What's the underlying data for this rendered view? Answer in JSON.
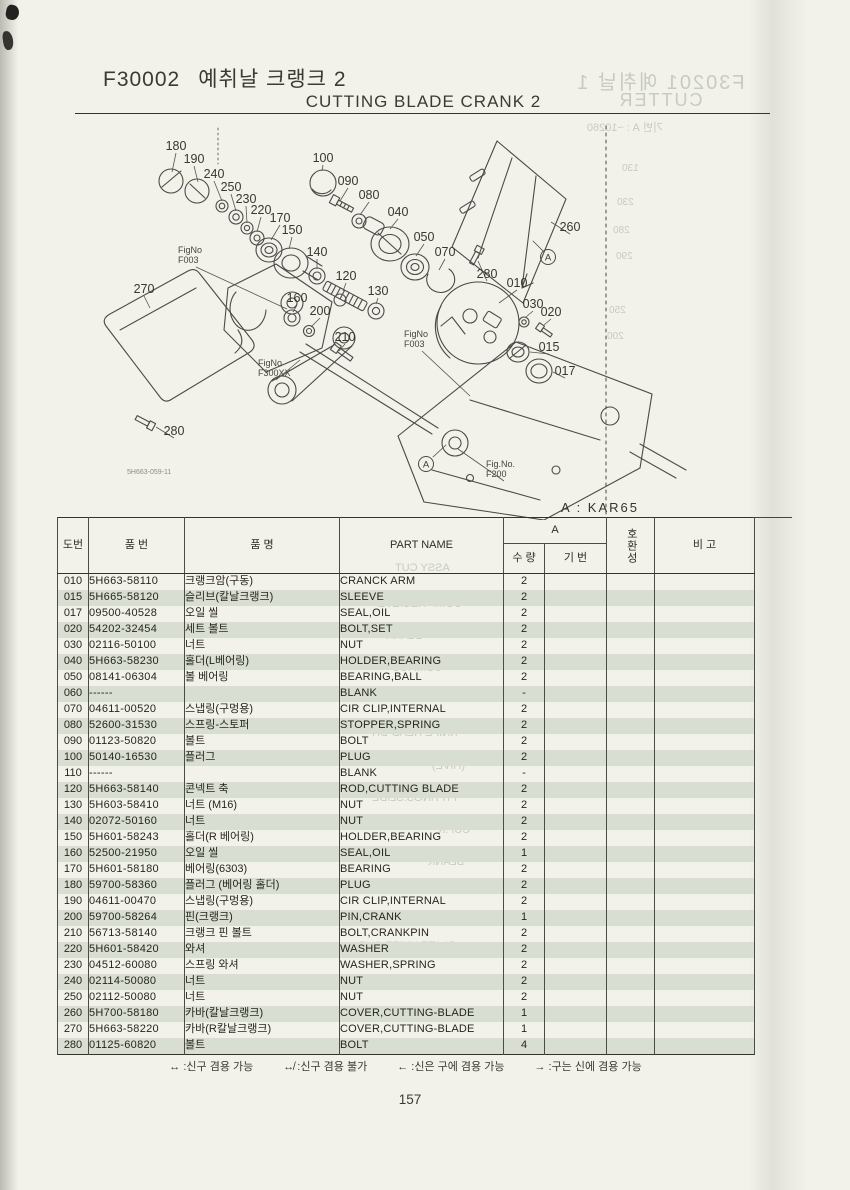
{
  "title": {
    "code": "F30002",
    "kr": "예취날 크랭크 2",
    "en": "CUTTING BLADE CRANK 2"
  },
  "applicability": {
    "label": "A : KAR65"
  },
  "page": {
    "number": "157"
  },
  "diagram": {
    "drawing_no": "5H663-059-11",
    "a_marker_label": "A",
    "a_markers": [
      {
        "x": 548,
        "y": 257
      },
      {
        "x": 426,
        "y": 464
      }
    ],
    "callouts": [
      {
        "label": "180",
        "x": 176,
        "y": 150,
        "lx": 172,
        "ly": 172
      },
      {
        "label": "190",
        "x": 194,
        "y": 163,
        "lx": 198,
        "ly": 182
      },
      {
        "label": "240",
        "x": 214,
        "y": 178,
        "lx": 222,
        "ly": 201
      },
      {
        "label": "250",
        "x": 231,
        "y": 191,
        "lx": 236,
        "ly": 211
      },
      {
        "label": "230",
        "x": 246,
        "y": 203,
        "lx": 247,
        "ly": 223
      },
      {
        "label": "220",
        "x": 261,
        "y": 214,
        "lx": 257,
        "ly": 232
      },
      {
        "label": "170",
        "x": 280,
        "y": 222,
        "lx": 271,
        "ly": 240
      },
      {
        "label": "150",
        "x": 292,
        "y": 234,
        "lx": 289,
        "ly": 249
      },
      {
        "label": "140",
        "x": 317,
        "y": 256,
        "lx": 317,
        "ly": 269
      },
      {
        "label": "100",
        "x": 323,
        "y": 162,
        "lx": 322,
        "ly": 171
      },
      {
        "label": "090",
        "x": 348,
        "y": 185,
        "lx": 340,
        "ly": 201
      },
      {
        "label": "080",
        "x": 369,
        "y": 199,
        "lx": 360,
        "ly": 215
      },
      {
        "label": "040",
        "x": 398,
        "y": 216,
        "lx": 390,
        "ly": 229
      },
      {
        "label": "050",
        "x": 424,
        "y": 241,
        "lx": 416,
        "ly": 256
      },
      {
        "label": "070",
        "x": 445,
        "y": 256,
        "lx": 439,
        "ly": 270
      },
      {
        "label": "120",
        "x": 346,
        "y": 280,
        "lx": 343,
        "ly": 291
      },
      {
        "label": "130",
        "x": 378,
        "y": 295,
        "lx": 376,
        "ly": 304
      },
      {
        "label": "260",
        "x": 570,
        "y": 231,
        "lx": 551,
        "ly": 222
      },
      {
        "label": "280",
        "x": 487,
        "y": 278,
        "lx": 478,
        "ly": 261
      },
      {
        "label": "010",
        "x": 517,
        "y": 287,
        "lx": 499,
        "ly": 303
      },
      {
        "label": "030",
        "x": 533,
        "y": 308,
        "lx": 526,
        "ly": 317
      },
      {
        "label": "020",
        "x": 551,
        "y": 316,
        "lx": 544,
        "ly": 325
      },
      {
        "label": "015",
        "x": 549,
        "y": 351,
        "lx": 530,
        "ly": 352
      },
      {
        "label": "017",
        "x": 565,
        "y": 375,
        "lx": 553,
        "ly": 372
      },
      {
        "label": "270",
        "x": 144,
        "y": 293,
        "lx": 150,
        "ly": 308
      },
      {
        "label": "280",
        "x": 174,
        "y": 435,
        "lx": 156,
        "ly": 427
      },
      {
        "label": "160",
        "x": 297,
        "y": 302,
        "lx": 293,
        "ly": 312
      },
      {
        "label": "200",
        "x": 320,
        "y": 315,
        "lx": 311,
        "ly": 327
      },
      {
        "label": "210",
        "x": 345,
        "y": 341,
        "lx": 339,
        "ly": 351
      }
    ],
    "fig_labels": [
      {
        "lines": [
          "FigNo",
          "F003"
        ],
        "x": 178,
        "y": 253,
        "lx": 287,
        "ly": 309
      },
      {
        "lines": [
          "FigNo",
          "F300XX"
        ],
        "x": 258,
        "y": 366,
        "lx": 300,
        "ly": 360
      },
      {
        "lines": [
          "FigNo",
          "F003"
        ],
        "x": 404,
        "y": 337,
        "lx": 470,
        "ly": 396
      },
      {
        "lines": [
          "Fig.No.",
          "F200"
        ],
        "x": 486,
        "y": 467,
        "lx": 458,
        "ly": 449
      }
    ]
  },
  "table": {
    "headers": {
      "no": "도번",
      "part_no": "품   번",
      "name_kr": "품      명",
      "part_name": "PART NAME",
      "group": "A",
      "qty": "수 량",
      "serial": "기 번",
      "interchange": "호환성",
      "remarks": "비   고"
    },
    "rows": [
      {
        "no": "010",
        "part_no": "5H663-58110",
        "name_kr": "크랭크암(구동)",
        "part_name": "CRANCK ARM",
        "qty": "2"
      },
      {
        "no": "015",
        "part_no": "5H665-58120",
        "name_kr": "슬리브(칼날크랭크)",
        "part_name": "SLEEVE",
        "qty": "2"
      },
      {
        "no": "017",
        "part_no": "09500-40528",
        "name_kr": "오일 씰",
        "part_name": "SEAL,OIL",
        "qty": "2"
      },
      {
        "no": "020",
        "part_no": "54202-32454",
        "name_kr": "세트 볼트",
        "part_name": "BOLT,SET",
        "qty": "2"
      },
      {
        "no": "030",
        "part_no": "02116-50100",
        "name_kr": "너트",
        "part_name": "NUT",
        "qty": "2"
      },
      {
        "no": "040",
        "part_no": "5H663-58230",
        "name_kr": "홀더(L베어링)",
        "part_name": "HOLDER,BEARING",
        "qty": "2"
      },
      {
        "no": "050",
        "part_no": "08141-06304",
        "name_kr": "볼 베어링",
        "part_name": "BEARING,BALL",
        "qty": "2"
      },
      {
        "no": "060",
        "part_no": "------",
        "name_kr": "",
        "part_name": "BLANK",
        "qty": "-"
      },
      {
        "no": "070",
        "part_no": "04611-00520",
        "name_kr": "스냅링(구멍용)",
        "part_name": "CIR CLIP,INTERNAL",
        "qty": "2"
      },
      {
        "no": "080",
        "part_no": "52600-31530",
        "name_kr": "스프링-스토퍼",
        "part_name": "STOPPER,SPRING",
        "qty": "2"
      },
      {
        "no": "090",
        "part_no": "01123-50820",
        "name_kr": "볼트",
        "part_name": "BOLT",
        "qty": "2"
      },
      {
        "no": "100",
        "part_no": "50140-16530",
        "name_kr": "플러그",
        "part_name": "PLUG",
        "qty": "2"
      },
      {
        "no": "110",
        "part_no": "------",
        "name_kr": "",
        "part_name": "BLANK",
        "qty": "-"
      },
      {
        "no": "120",
        "part_no": "5H663-58140",
        "name_kr": "콘넥트 축",
        "part_name": "ROD,CUTTING BLADE",
        "qty": "2"
      },
      {
        "no": "130",
        "part_no": "5H603-58410",
        "name_kr": "너트 (M16)",
        "part_name": "NUT",
        "qty": "2"
      },
      {
        "no": "140",
        "part_no": "02072-50160",
        "name_kr": "너트",
        "part_name": "NUT",
        "qty": "2"
      },
      {
        "no": "150",
        "part_no": "5H601-58243",
        "name_kr": "홀더(R 베어링)",
        "part_name": "HOLDER,BEARING",
        "qty": "2"
      },
      {
        "no": "160",
        "part_no": "52500-21950",
        "name_kr": "오일 씰",
        "part_name": "SEAL,OIL",
        "qty": "1"
      },
      {
        "no": "170",
        "part_no": "5H601-58180",
        "name_kr": "베어링(6303)",
        "part_name": "BEARING",
        "qty": "2"
      },
      {
        "no": "180",
        "part_no": "59700-58360",
        "name_kr": "플러그 (베어링 홀더)",
        "part_name": "PLUG",
        "qty": "2"
      },
      {
        "no": "190",
        "part_no": "04611-00470",
        "name_kr": "스냅링(구멍용)",
        "part_name": "CIR CLIP,INTERNAL",
        "qty": "2"
      },
      {
        "no": "200",
        "part_no": "59700-58264",
        "name_kr": "핀(크랭크)",
        "part_name": "PIN,CRANK",
        "qty": "1"
      },
      {
        "no": "210",
        "part_no": "56713-58140",
        "name_kr": "크랭크 핀 볼트",
        "part_name": "BOLT,CRANKPIN",
        "qty": "2"
      },
      {
        "no": "220",
        "part_no": "5H601-58420",
        "name_kr": "와셔",
        "part_name": "WASHER",
        "qty": "2"
      },
      {
        "no": "230",
        "part_no": "04512-60080",
        "name_kr": "스프링 와셔",
        "part_name": "WASHER,SPRING",
        "qty": "2"
      },
      {
        "no": "240",
        "part_no": "02114-50080",
        "name_kr": "너트",
        "part_name": "NUT",
        "qty": "2"
      },
      {
        "no": "250",
        "part_no": "02112-50080",
        "name_kr": "너트",
        "part_name": "NUT",
        "qty": "2"
      },
      {
        "no": "260",
        "part_no": "5H700-58180",
        "name_kr": "카바(칼날크랭크)",
        "part_name": "COVER,CUTTING-BLADE",
        "qty": "1"
      },
      {
        "no": "270",
        "part_no": "5H663-58220",
        "name_kr": "카바(R칼날크랭크)",
        "part_name": "COVER,CUTTING-BLADE",
        "qty": "1"
      },
      {
        "no": "280",
        "part_no": "01125-60820",
        "name_kr": "볼트",
        "part_name": "BOLT",
        "qty": "4"
      }
    ]
  },
  "legend": {
    "items": [
      {
        "symbol": "↔",
        "text": ":신구 겸용 가능"
      },
      {
        "symbol": "↮",
        "text": ":신구 겸용 불가"
      },
      {
        "symbol": "←",
        "text": ":신은 구에 겸용 가능"
      },
      {
        "symbol": "→",
        "text": ":구는 신에 겸용 가능"
      }
    ]
  },
  "bleed": {
    "header1": "F30201 예취날 1",
    "header2": "CUTTER",
    "subheader": "기번 A : ~10260",
    "fragments": [
      {
        "text": "ASSY CUT",
        "x": 395,
        "y": 562,
        "fs": 11
      },
      {
        "text": "COMP RECIEVE",
        "x": 378,
        "y": 598,
        "fs": 11
      },
      {
        "text": "BLANK",
        "x": 386,
        "y": 630,
        "fs": 11
      },
      {
        "text": "COMP.CU",
        "x": 392,
        "y": 662,
        "fs": 11
      },
      {
        "text": "KNIFE HEAD-DH",
        "x": 372,
        "y": 727,
        "fs": 11
      },
      {
        "text": "(HIVE)",
        "x": 432,
        "y": 760,
        "fs": 11
      },
      {
        "text": "FITTINGS.SLIDE",
        "x": 372,
        "y": 792,
        "fs": 11
      },
      {
        "text": "CUP.K",
        "x": 438,
        "y": 824,
        "fs": 11
      },
      {
        "text": "BLANK",
        "x": 428,
        "y": 856,
        "fs": 11
      },
      {
        "text": "PLATE.KNIFE CLIP",
        "x": 358,
        "y": 940,
        "fs": 11
      },
      {
        "text": "130",
        "x": 622,
        "y": 163,
        "fs": 10
      },
      {
        "text": "230",
        "x": 617,
        "y": 197,
        "fs": 10
      },
      {
        "text": "280",
        "x": 613,
        "y": 225,
        "fs": 10
      },
      {
        "text": "290",
        "x": 616,
        "y": 251,
        "fs": 10
      },
      {
        "text": "250",
        "x": 609,
        "y": 305,
        "fs": 10
      },
      {
        "text": "200",
        "x": 607,
        "y": 331,
        "fs": 10
      }
    ]
  },
  "colors": {
    "paper": "#f2f1ea",
    "row_shade": "#d8ded2",
    "line": "#4a4a48",
    "bleed_text": "#c6ccc1"
  }
}
